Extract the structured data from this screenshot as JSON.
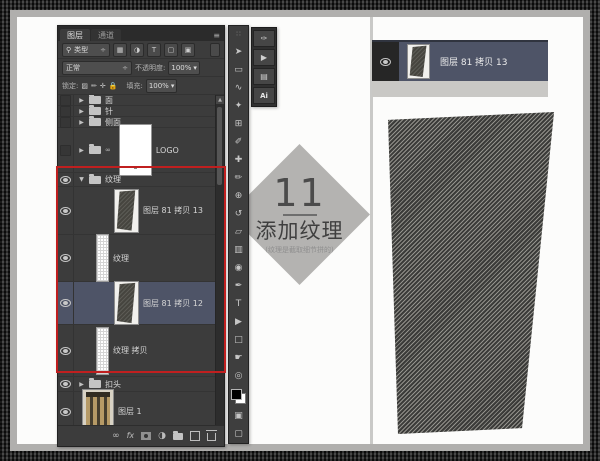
{
  "colors": {
    "accent_red": "#c01f1f",
    "selected_row": "#4e5467",
    "panel_bg": "#3c3c3c",
    "diamond_gray": "#b4b3b1",
    "texture_dark": "#3b3b39",
    "texture_light": "#93928c"
  },
  "layers_panel": {
    "tabs": [
      {
        "label": "图层"
      },
      {
        "label": "通道"
      }
    ],
    "menu_icon": "≡",
    "filter": {
      "search_glyph": "⚲",
      "kind_label": "类型",
      "stepper": "÷",
      "filter_icons": [
        {
          "name": "pixel-filter-icon",
          "glyph": "▦"
        },
        {
          "name": "adjustment-filter-icon",
          "glyph": "◑"
        },
        {
          "name": "type-filter-icon",
          "glyph": "T"
        },
        {
          "name": "shape-filter-icon",
          "glyph": "▢"
        },
        {
          "name": "smart-object-filter-icon",
          "glyph": "▣"
        }
      ]
    },
    "blend": {
      "mode": "正常",
      "stepper": "÷",
      "opacity_label": "不透明度:",
      "opacity_value": "100%",
      "caret": "▾"
    },
    "lock": {
      "label": "锁定:",
      "icons": [
        {
          "name": "lock-transparency-icon",
          "glyph": "▨"
        },
        {
          "name": "lock-pixels-icon",
          "glyph": "✏"
        },
        {
          "name": "lock-position-icon",
          "glyph": "✛"
        },
        {
          "name": "lock-all-icon",
          "glyph": "🔒"
        }
      ],
      "fill_label": "填充:",
      "fill_value": "100%",
      "caret": "▾"
    },
    "rows": [
      {
        "name": "面"
      },
      {
        "name": "针"
      },
      {
        "name": "侧面"
      },
      {
        "name": "LOGO"
      },
      {
        "name": "纹理"
      },
      {
        "name": "图层 81 拷贝 13"
      },
      {
        "name": "纹理"
      },
      {
        "name": "图层 81 拷贝 12"
      },
      {
        "name": "纹理 拷贝"
      },
      {
        "name": "扣头"
      },
      {
        "name": "图层 1"
      }
    ],
    "footer": {
      "link": "∞",
      "fx": "fx",
      "adjustment": "◑"
    },
    "scroll_up": "▲"
  },
  "toolbar": {
    "tools": [
      {
        "name": "toolbar-grip",
        "glyph": "∷"
      },
      {
        "name": "move-tool",
        "glyph": "➤"
      },
      {
        "name": "marquee-tool",
        "glyph": "▭"
      },
      {
        "name": "lasso-tool",
        "glyph": "∿"
      },
      {
        "name": "quick-selection-tool",
        "glyph": "✦"
      },
      {
        "name": "crop-tool",
        "glyph": "⊞"
      },
      {
        "name": "eyedropper-tool",
        "glyph": "✐"
      },
      {
        "name": "healing-brush-tool",
        "glyph": "✚"
      },
      {
        "name": "brush-tool",
        "glyph": "✏"
      },
      {
        "name": "clone-stamp-tool",
        "glyph": "⊕"
      },
      {
        "name": "history-brush-tool",
        "glyph": "↺"
      },
      {
        "name": "eraser-tool",
        "glyph": "▱"
      },
      {
        "name": "gradient-tool",
        "glyph": "▥"
      },
      {
        "name": "blur-tool",
        "glyph": "◉"
      },
      {
        "name": "pen-tool",
        "glyph": "✒"
      },
      {
        "name": "type-tool",
        "glyph": "T"
      },
      {
        "name": "path-selection-tool",
        "glyph": "▶"
      },
      {
        "name": "shape-tool",
        "glyph": "□"
      },
      {
        "name": "hand-tool",
        "glyph": "☛"
      },
      {
        "name": "zoom-tool",
        "glyph": "◎"
      }
    ],
    "quick_mask_glyph": "▣",
    "screen_mode_glyph": "▢"
  },
  "dock": {
    "icons": [
      {
        "name": "brush-panel-icon",
        "glyph": "✑"
      },
      {
        "name": "actions-panel-icon",
        "glyph": "▶"
      },
      {
        "name": "styles-panel-icon",
        "glyph": "▤"
      },
      {
        "name": "ai-panel-icon",
        "glyph": "Ai"
      }
    ]
  },
  "badge": {
    "number": "11",
    "title": "添加纹理",
    "subtitle": "(纹理是截取细节拼的)"
  },
  "excerpt": {
    "layer_name": "图层 81 拷贝 13"
  }
}
